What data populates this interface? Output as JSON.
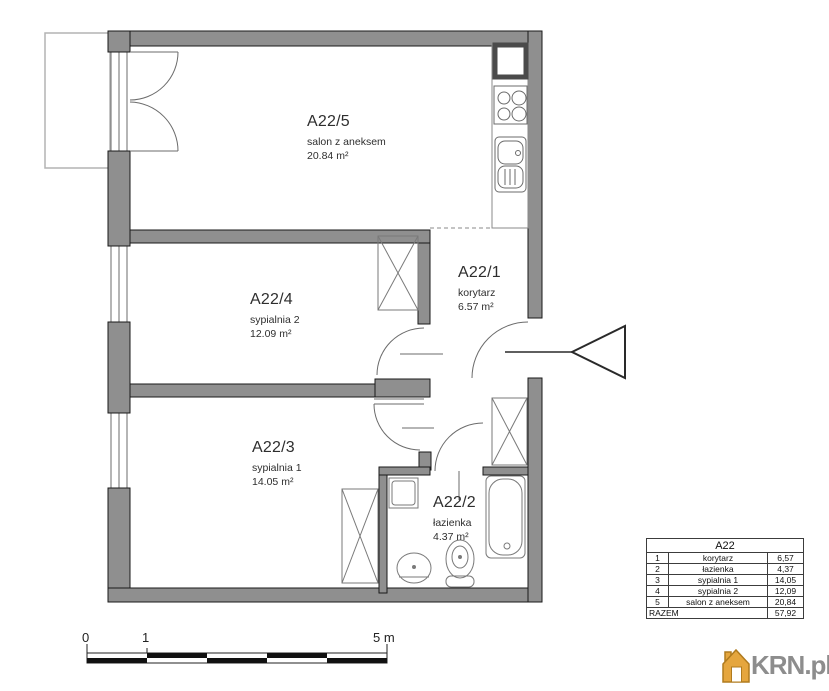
{
  "plan": {
    "rooms": [
      {
        "id": "A22/5",
        "name": "salon z aneksem",
        "area": "20.84 m²"
      },
      {
        "id": "A22/4",
        "name": "sypialnia 2",
        "area": "12.09 m²"
      },
      {
        "id": "A22/3",
        "name": "sypialnia 1",
        "area": "14.05 m²"
      },
      {
        "id": "A22/1",
        "name": "korytarz",
        "area": "6.57 m²"
      },
      {
        "id": "A22/2",
        "name": "łazienka",
        "area": "4.37 m²"
      }
    ]
  },
  "scale_bar": {
    "labels": [
      "0",
      "1",
      "5 m"
    ]
  },
  "legend_table": {
    "title": "A22",
    "rows": [
      {
        "no": "1",
        "name": "korytarz",
        "area": "6,57"
      },
      {
        "no": "2",
        "name": "łazienka",
        "area": "4,37"
      },
      {
        "no": "3",
        "name": "sypialnia 1",
        "area": "14,05"
      },
      {
        "no": "4",
        "name": "sypialnia 2",
        "area": "12,09"
      },
      {
        "no": "5",
        "name": "salon z aneksem",
        "area": "20,84"
      }
    ],
    "total_label": "RAZEM",
    "total_area": "57,92"
  },
  "logo": {
    "text": "KRN.pl"
  },
  "colors": {
    "wall": "#8f8f8f",
    "logo_orange": "#e5a63e",
    "logo_gray": "#8d8d8d"
  }
}
